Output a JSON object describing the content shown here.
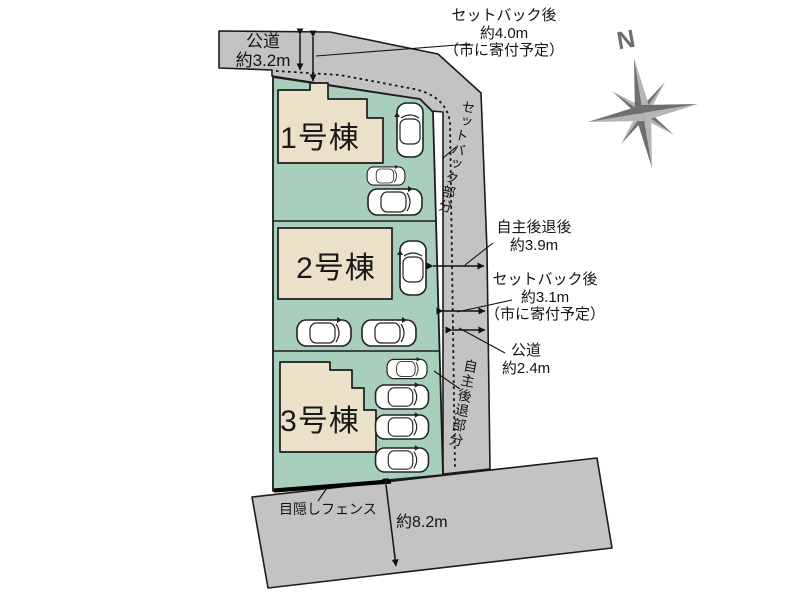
{
  "diagram": {
    "type": "real-estate-site-plan",
    "compass_label": "N",
    "buildings": [
      {
        "label": "1号棟"
      },
      {
        "label": "2号棟"
      },
      {
        "label": "3号棟"
      }
    ],
    "labels": {
      "top_road": {
        "l1": "公道",
        "l2": "約3.2m"
      },
      "setback_top": {
        "l1": "セットバック後",
        "l2": "約4.0m",
        "l3": "（市に寄付予定）"
      },
      "setback_vertical": "セットバック部分",
      "voluntary_after": {
        "l1": "自主後退後",
        "l2": "約3.9m"
      },
      "setback_right": {
        "l1": "セットバック後",
        "l2": "約3.1m",
        "l3": "（市に寄付予定）"
      },
      "right_road": {
        "l1": "公道",
        "l2": "約2.4m"
      },
      "voluntary_vertical": "自主後退部分",
      "fence": "目隠しフェンス",
      "bottom_width": "約8.2m"
    },
    "colors": {
      "road": "#c3c3c3",
      "lot_green": "#a8cebc",
      "building_beige": "#ebe0c8",
      "outline": "#1b1b1b",
      "compass_dark": "#6e6e6e",
      "compass_light": "#b5b5b5"
    }
  }
}
